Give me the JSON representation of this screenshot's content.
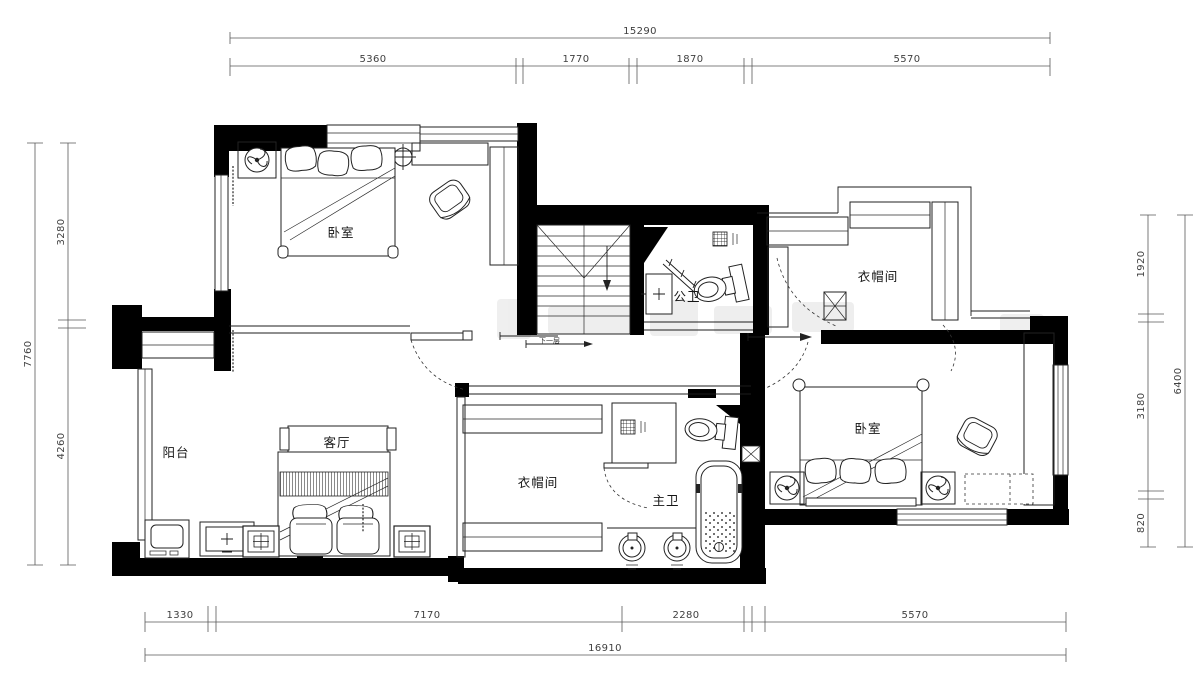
{
  "dimensions": {
    "top": {
      "total": "15290",
      "segments": [
        "5360",
        "1770",
        "1870",
        "5570"
      ]
    },
    "left": {
      "total": "7760",
      "segments": [
        "3280",
        "4260"
      ]
    },
    "right": {
      "total": "6400",
      "segments": [
        "1920",
        "3180",
        "820"
      ]
    },
    "bottom": {
      "total": "16910",
      "segments": [
        "1330",
        "7170",
        "2280",
        "5570"
      ]
    }
  },
  "rooms": {
    "bedroom_top": "卧室",
    "cloakroom_top": "衣帽间",
    "public_bath": "公卫",
    "balcony": "阳台",
    "living": "客厅",
    "cloakroom_bottom": "衣帽间",
    "master_bath": "主卫",
    "bedroom_right": "卧室"
  },
  "stairs": {
    "note": "下一层"
  },
  "colors": {
    "wall": "#000000",
    "line": "#1c1c1c",
    "dim_text": "#3f3f3f",
    "paper": "#ffffff",
    "watermark": "#9a9a9a"
  }
}
